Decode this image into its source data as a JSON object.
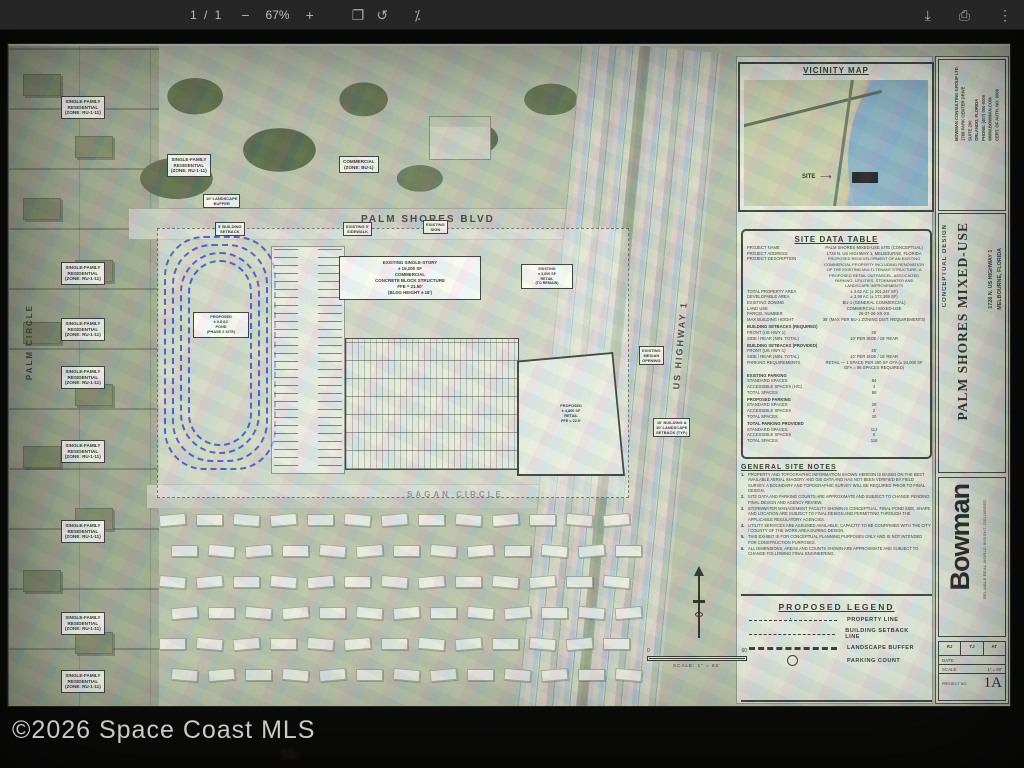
{
  "toolbar": {
    "page_indicator": "1 / 1",
    "zoom_out": "−",
    "zoom_level": "67%",
    "zoom_in": "+",
    "icons": {
      "fit_page": "❐",
      "rotate": "↺",
      "presentation": "⁒",
      "download": "⤓",
      "print": "⎙",
      "more": "⋮"
    }
  },
  "photo": {
    "watermark": "©2026 Space Coast MLS",
    "faint_text": "Mc"
  },
  "plan": {
    "roads": {
      "palm_shores_blvd": "PALM SHORES BLVD",
      "sagan_circle": "SAGAN CIRCLE",
      "palm_circle": "PALM CIRCLE",
      "us_highway": "US HIGHWAY 1"
    },
    "aerial_labels": [
      {
        "t": "SINGLE-FAMILY\nRESIDENTIAL\n(ZONE: RU-1-11)",
        "x": 52,
        "y": 50
      },
      {
        "t": "SINGLE-FAMILY\nRESIDENTIAL\n(ZONE: RU-1-11)",
        "x": 158,
        "y": 108
      },
      {
        "t": "COMMERCIAL\n(ZONE: BU-1)",
        "x": 330,
        "y": 110
      },
      {
        "t": "SINGLE-FAMILY\nRESIDENTIAL\n(ZONE: RU-1-11)",
        "x": 52,
        "y": 216
      },
      {
        "t": "SINGLE-FAMILY\nRESIDENTIAL\n(ZONE: RU-1-11)",
        "x": 52,
        "y": 272
      },
      {
        "t": "SINGLE-FAMILY\nRESIDENTIAL\n(ZONE: RU-1-11)",
        "x": 52,
        "y": 320
      },
      {
        "t": "SINGLE-FAMILY\nRESIDENTIAL\n(ZONE: RU-1-11)",
        "x": 52,
        "y": 394
      },
      {
        "t": "SINGLE-FAMILY\nRESIDENTIAL\n(ZONE: RU-1-11)",
        "x": 52,
        "y": 474
      },
      {
        "t": "SINGLE-FAMILY\nRESIDENTIAL\n(ZONE: RU-1-11)",
        "x": 52,
        "y": 566
      },
      {
        "t": "SINGLE-FAMILY\nRESIDENTIAL\n(ZONE: RU-1-11)",
        "x": 52,
        "y": 624
      },
      {
        "t": "10' LANDSCAPE\nBUFFER",
        "x": 194,
        "y": 148,
        "cls": "tiny"
      },
      {
        "t": "5' BUILDING\nSETBACK",
        "x": 206,
        "y": 176,
        "cls": "tiny"
      },
      {
        "t": "EXISTING 5'\nSIDEWALK",
        "x": 334,
        "y": 176,
        "cls": "tiny"
      },
      {
        "t": "EXISTING\nSIGN",
        "x": 414,
        "y": 174,
        "cls": "tiny"
      },
      {
        "t": "EXISTING\nMEDIAN\nOPENING",
        "x": 630,
        "y": 300,
        "cls": "tiny"
      },
      {
        "t": "10' BUILDING &\n10' LANDSCAPE\nSETBACK (TYP.)",
        "x": 644,
        "y": 372,
        "cls": "tiny"
      }
    ],
    "pond_label": "PROPOSED\n± 0.8 AC\nPOND\n(PHASE 2 SITE)",
    "building_labels": {
      "existing_main": "EXISTING SINGLE-STORY\n± 19,200 SF\nCOMMERCIAL\nCONCRETE BLOCK STRUCTURE\nFFE = 21.50'\n(BLDG HEIGHT ± 18')",
      "existing_outparcel": "EXISTING\n± 3,600 SF\nRETAIL\n(TO REMAIN)",
      "proposed_retail": "PROPOSED\n± 4,800 SF\nRETAIL\nFFE = 22.0'"
    },
    "scale_bar": {
      "zero": "0",
      "sixty": "60",
      "caption": "SCALE: 1\" = 60'"
    },
    "vicinity": {
      "title": "VICINITY MAP",
      "site_label": "SITE",
      "arrow": "⟶"
    },
    "site_data_table": {
      "title": "SITE DATA TABLE",
      "rows": [
        {
          "l": "PROJECT NAME",
          "v": "PALM SHORES MIXED-USE SITE (CONCEPTUAL)"
        },
        {
          "l": "PROJECT ADDRESS",
          "v": "1728 N. US HIGHWAY 1, MELBOURNE, FLORIDA"
        },
        {
          "l": "PROJECT DESCRIPTION",
          "v": "PROPOSED REDEVELOPMENT OF AN EXISTING COMMERCIAL PROPERTY INCLUDING RENOVATION OF THE EXISTING MULTI-TENANT STRUCTURE, A PROPOSED RETAIL OUTPARCEL, ASSOCIATED PARKING, UTILITIES, STORMWATER AND LANDSCAPE IMPROVEMENTS",
          "cls": "tall"
        },
        {
          "l": "TOTAL PROPERTY AREA",
          "v": "± 4.62 AC (± 201,247 SF)"
        },
        {
          "l": "DEVELOPABLE AREA",
          "v": "± 3.98 AC (± 173,369 SF)"
        },
        {
          "l": "EXISTING ZONING",
          "v": "BU-1 (GENERAL COMMERCIAL)"
        },
        {
          "l": "LAND USE",
          "v": "COMMERCIAL / MIXED-USE"
        },
        {
          "l": "PARCEL NUMBER",
          "v": "26-37-26-XX-XX"
        },
        {
          "l": "MAX BUILDING HEIGHT",
          "v": "35' (MAX PER BU-1 ZONING DIST. REQUIREMENTS)"
        },
        {
          "l": "BUILDING SETBACKS (REQUIRED)",
          "v": "",
          "cls": "sec"
        },
        {
          "l": "FRONT (US HWY 1)",
          "v": "25'"
        },
        {
          "l": "SIDE / REAR (MIN. TOTAL)",
          "v": "10' PER SIDE / 15' REAR"
        },
        {
          "l": "BUILDING SETBACKS (PROVIDED)",
          "v": "",
          "cls": "sec"
        },
        {
          "l": "FRONT (US HWY 1)",
          "v": "25'"
        },
        {
          "l": "SIDE / REAR (MIN. TOTAL)",
          "v": "10' PER SIDE / 15' REAR"
        },
        {
          "l": "PARKING REQUIREMENTS",
          "v": "RETAIL — 1 SPACE PER 250 SF GFA (± 24,000 SF GFA = 96 SPACES REQUIRED)"
        },
        {
          "l": "EXISTING PARKING",
          "v": "",
          "cls": "sec"
        },
        {
          "l": "STANDARD SPACES",
          "v": "84"
        },
        {
          "l": "ACCESSIBLE SPACES (H/C)",
          "v": "4"
        },
        {
          "l": "TOTAL SPACES",
          "v": "88"
        },
        {
          "l": "PROPOSED PARKING",
          "v": "",
          "cls": "sec"
        },
        {
          "l": "STANDARD SPACES",
          "v": "28"
        },
        {
          "l": "ACCESSIBLE SPACES",
          "v": "2"
        },
        {
          "l": "TOTAL SPACES",
          "v": "30"
        },
        {
          "l": "TOTAL PARKING PROVIDED",
          "v": "",
          "cls": "sec"
        },
        {
          "l": "STANDARD SPACES",
          "v": "112"
        },
        {
          "l": "ACCESSIBLE SPACES",
          "v": "6"
        },
        {
          "l": "TOTAL SPACES",
          "v": "118"
        }
      ]
    },
    "general_notes": {
      "title": "GENERAL SITE NOTES",
      "notes": [
        "PROPERTY AND TOPOGRAPHIC INFORMATION SHOWN HEREON IS BASED ON THE BEST AVAILABLE AERIAL IMAGERY AND GIS DATA AND HAS NOT BEEN VERIFIED BY FIELD SURVEY. A BOUNDARY AND TOPOGRAPHIC SURVEY WILL BE REQUIRED PRIOR TO FINAL DESIGN.",
        "SITE DATA AND PARKING COUNTS ARE APPROXIMATE AND SUBJECT TO CHANGE PENDING FINAL DESIGN AND AGENCY REVIEW.",
        "STORMWATER MANAGEMENT FACILITY SHOWN IS CONCEPTUAL. FINAL POND SIZE, SHAPE AND LOCATION ARE SUBJECT TO FINAL DESIGN AND PERMITTING THROUGH THE APPLICABLE REGULATORY AGENCIES.",
        "UTILITY SERVICES ARE ASSUMED AVAILABLE; CAPACITY TO BE CONFIRMED WITH THE CITY / COUNTY OF THE WORK AREA DURING DESIGN.",
        "THIS EXHIBIT IS FOR CONCEPTUAL PLANNING PURPOSES ONLY AND IS NOT INTENDED FOR CONSTRUCTION PURPOSES.",
        "ALL DIMENSIONS, AREAS AND COUNTS SHOWN ARE APPROXIMATE AND SUBJECT TO CHANGE FOLLOWING FINAL ENGINEERING."
      ]
    },
    "legend": {
      "title": "PROPOSED LEGEND",
      "items": [
        {
          "cls": "dashdot",
          "label": "PROPERTY LINE"
        },
        {
          "cls": "dashed",
          "label": "BUILDING SETBACK LINE"
        },
        {
          "cls": "buffer",
          "label": "LANDSCAPE BUFFER"
        },
        {
          "cls": "circlesym",
          "label": "PARKING COUNT"
        }
      ]
    },
    "title_block": {
      "consultant": "BOWMAN CONSULTING GROUP LTD.\n1768 PARK CENTER DRIVE\nSUITE 200\nORLANDO, FLORIDA\nPHONE: (407) 000-0000\nWWW.BOWMAN.COM\nCERT. OF AUTH. NO. 0000",
      "design_phase": "CONCEPTUAL DESIGN",
      "project_title": "PALM SHORES MIXED-USE",
      "address": "1728 N. US HIGHWAY 1\nMELBOURNE, FLORIDA",
      "firm": "Bowman",
      "firm_tagline": "RELIABLE REAL-WORLD INSIGHT. DELIVERED.",
      "initials": [
        "RJ",
        "TJ",
        "AT"
      ],
      "date_label": "DATE:",
      "date_value": "",
      "scale_label": "SCALE:",
      "scale_value": "1\" = 60'",
      "project_no_label": "PROJECT NO.",
      "sheet_number": "1A"
    }
  }
}
